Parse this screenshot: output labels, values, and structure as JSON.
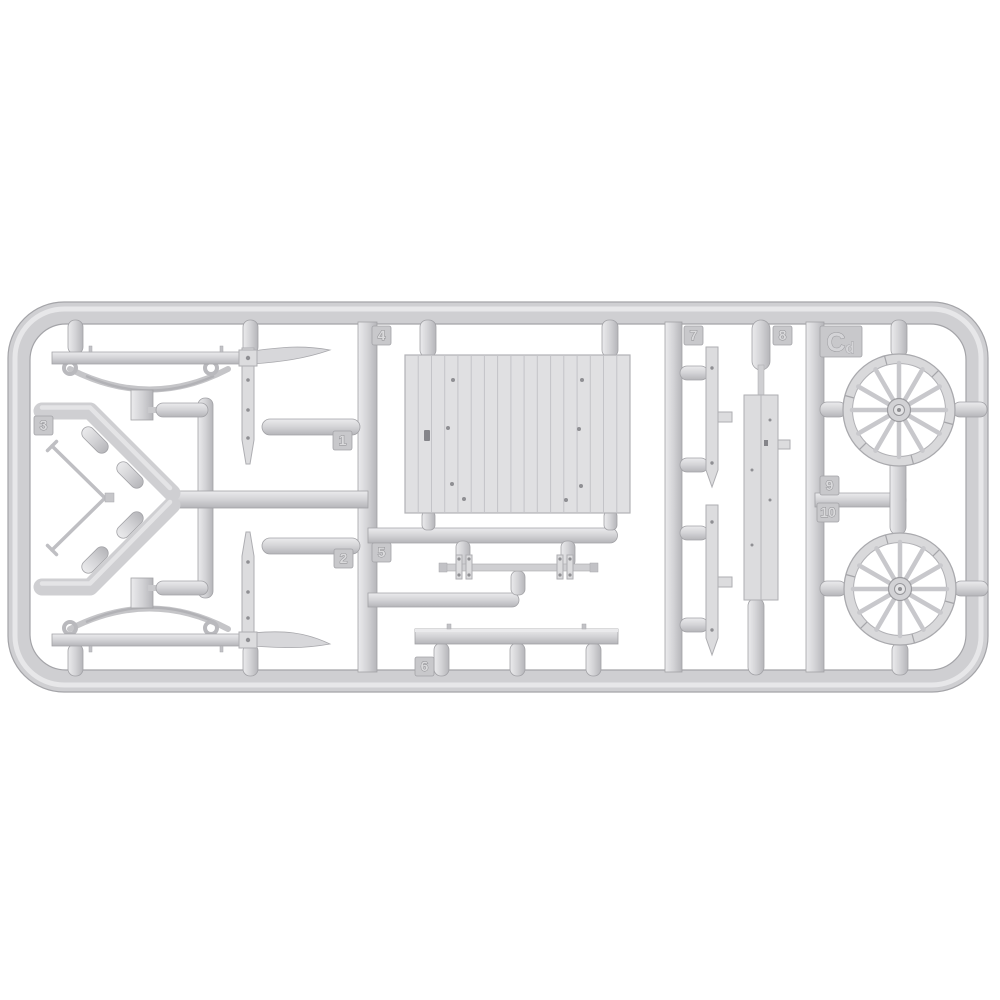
{
  "scene": {
    "type": "product-photo",
    "subject": "injection-molded light gray plastic model kit sprue with horse-drawn wagon parts",
    "background_color": "#ffffff",
    "plastic_color": "#d3d3d6",
    "plastic_highlight": "#ebebed",
    "plastic_shadow": "#a8a8ac"
  },
  "sprue": {
    "material_code": "Cd",
    "part_tags": [
      {
        "label": "1"
      },
      {
        "label": "2"
      },
      {
        "label": "3"
      },
      {
        "label": "4"
      },
      {
        "label": "5"
      },
      {
        "label": "6"
      },
      {
        "label": "7"
      },
      {
        "label": "8"
      },
      {
        "label": "9"
      },
      {
        "label": "10"
      }
    ],
    "parts": [
      {
        "name": "axle-beam-with-leaf-spring-top"
      },
      {
        "name": "axle-beam-with-leaf-spring-bottom"
      },
      {
        "name": "v-shaped-draft-pole"
      },
      {
        "name": "planked-floor-panel"
      },
      {
        "name": "tie-rod-with-clamps"
      },
      {
        "name": "side-rail-beam"
      },
      {
        "name": "flat-stake-strip-upper"
      },
      {
        "name": "flat-stake-strip-lower"
      },
      {
        "name": "long-planked-side-beam"
      },
      {
        "name": "spoked-wheel-upper"
      },
      {
        "name": "spoked-wheel-lower"
      }
    ]
  }
}
